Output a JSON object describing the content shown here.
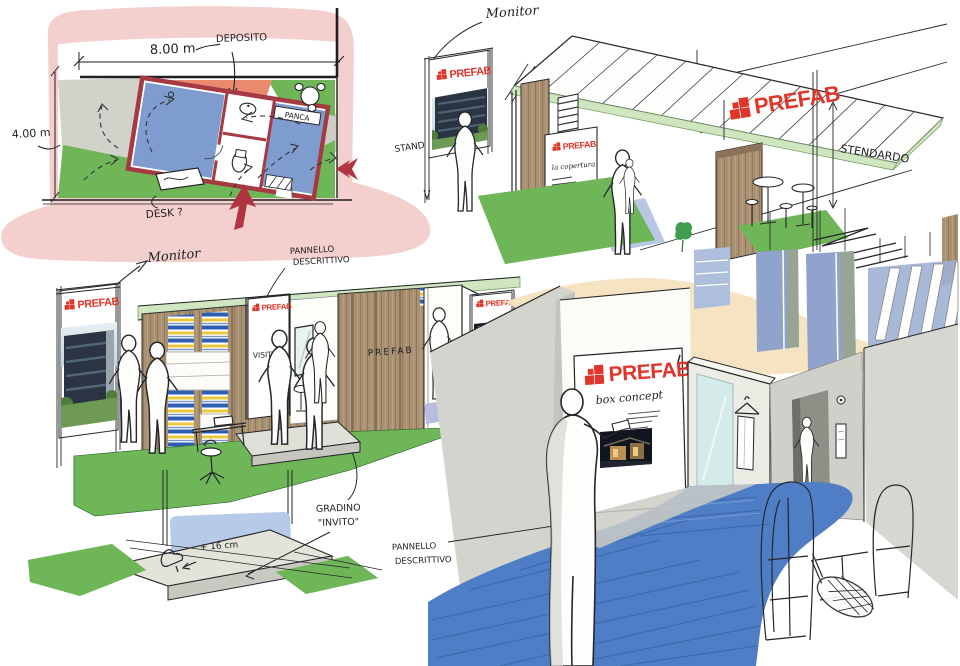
{
  "meta": {
    "type": "hand-drawn concept sketch sheet",
    "subject": "PREFAB exhibition stand / box concept"
  },
  "brand": {
    "name": "PREFAB",
    "logo_red": "#e0352b"
  },
  "palette": {
    "pink_wash": "#f3cfcd",
    "plan_wall_red": "#a63a42",
    "plan_room_blue": "#7e9ccd",
    "deposito_orange": "#e98a6e",
    "grass_green": "#6eb657",
    "roof_green": "#cfe6c0",
    "wood_tan": "#ab9173",
    "shelf_blue": "#2e5eb4",
    "shelf_yellow": "#e9c83d",
    "carpet_blue": "#4f7ec6",
    "wall_gray": "#d6d6d1",
    "ceiling_tan": "#f5e3c1",
    "banner_slate": "#8fa3cc",
    "glass_cyan": "#d4ebe9",
    "step_blue": "#b7cbe9",
    "ink": "#26262a",
    "arrow_red": "#b03441"
  },
  "floor_plan": {
    "dim_width": "8.00 m",
    "dim_height": "4.00 m",
    "labels": {
      "deposito": "DEPOSITO",
      "panca": "PANCA",
      "desk": "DESK ?"
    }
  },
  "exterior_sketch": {
    "labels": {
      "monitor": "Monitor",
      "stand": "STAND",
      "stendardo": "STENDARDO",
      "panel_note": "la copertura"
    }
  },
  "front_sketch": {
    "labels": {
      "monitor": "Monitor",
      "pannello_line1": "PANNELLO",
      "pannello_line2": "DESCRITTIVO",
      "visitaci": "VISITACI",
      "wall_brand": "PREFAB"
    }
  },
  "step_detail": {
    "labels": {
      "gradino_line1": "GRADINO",
      "gradino_line2": "\"INVITO\"",
      "height": "+ 16 cm"
    }
  },
  "interior_sketch": {
    "labels": {
      "box_concept": "box concept",
      "pannello_line1": "PANNELLO",
      "pannello_line2": "DESCRITTIVO",
      "signature_mark": "VI",
      "signature_year": "2012"
    }
  }
}
